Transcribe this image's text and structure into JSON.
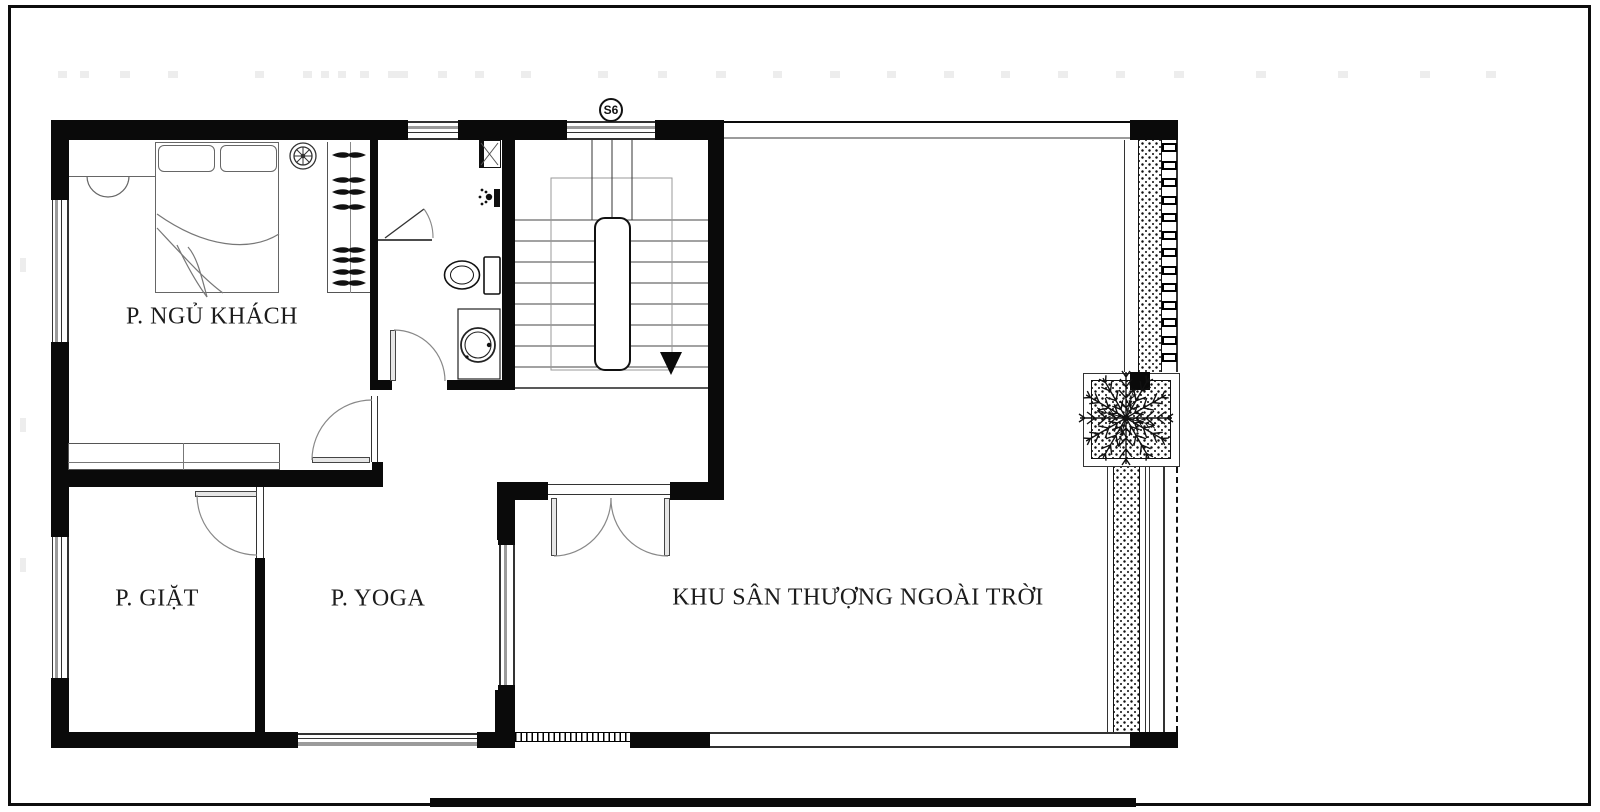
{
  "plan": {
    "title": "floor-plan",
    "rooms": [
      {
        "id": "guest-bedroom",
        "label": "P. NGỦ KHÁCH"
      },
      {
        "id": "laundry-room",
        "label": "P. GIẶT"
      },
      {
        "id": "yoga-room",
        "label": "P. YOGA"
      },
      {
        "id": "outdoor-terrace",
        "label": "KHU SÂN THƯỢNG NGOÀI TRỜI"
      }
    ],
    "window_marker": "S6",
    "fixtures": [
      "double-bed",
      "pillows",
      "ceiling-fan",
      "wardrobe-hangers",
      "bedside-lamp",
      "toilet",
      "washbasin",
      "shower-head",
      "exhaust-shaft",
      "stair-flight",
      "stair-down-arrow",
      "planter-tree",
      "louver-screen"
    ],
    "colors": {
      "wall": "#0a0a0a",
      "thin_line": "#333333",
      "glass_gray": "#9b9b9b",
      "paper": "#ffffff"
    }
  }
}
